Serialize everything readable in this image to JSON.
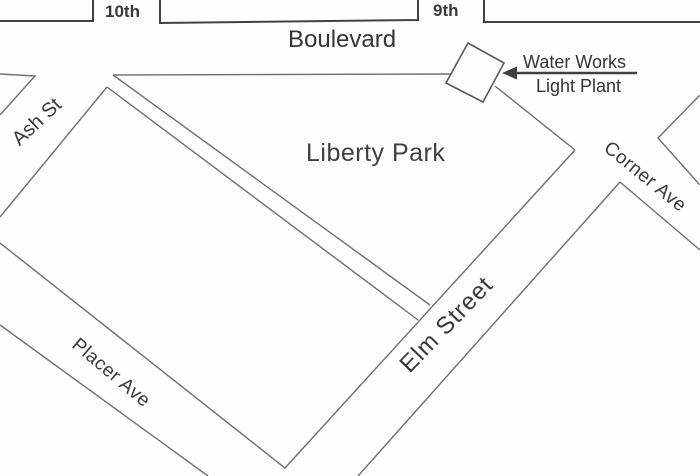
{
  "map": {
    "type": "street-map",
    "background_color": "#fdfdfd",
    "border_line_color": "#414141",
    "street_line_color": "#6e6e6e",
    "text_color": "#3a3a3a",
    "streets": {
      "tenth": "10th",
      "ninth": "9th",
      "boulevard": "Boulevard",
      "ash": "Ash St",
      "corner": "Corner Ave",
      "elm": "Elm Street",
      "placer": "Placer Ave"
    },
    "park": {
      "name": "Liberty Park"
    },
    "annotation": {
      "line1": "Water Works",
      "line2": "Light Plant"
    }
  }
}
